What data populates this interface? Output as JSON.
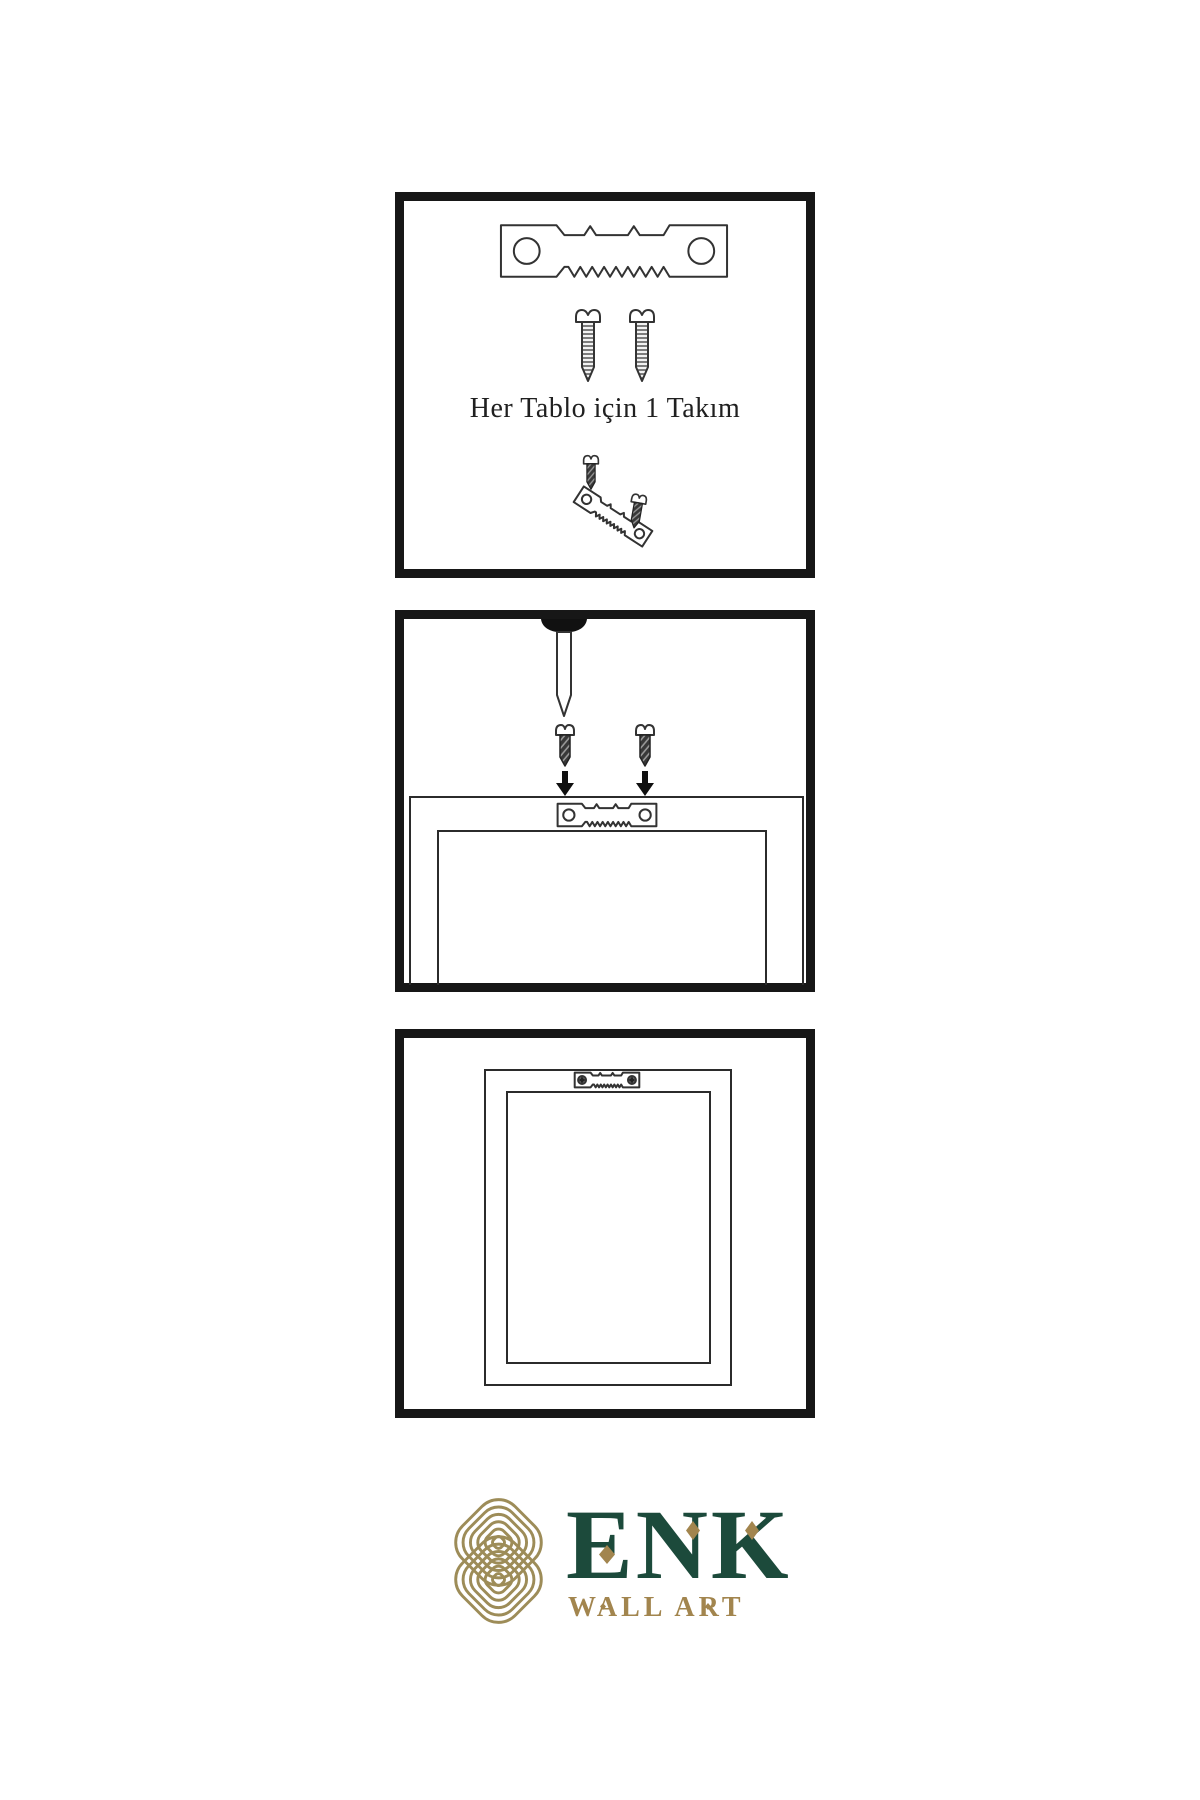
{
  "page": {
    "background": "#ffffff",
    "type": "product-instruction-sheet"
  },
  "steps": [
    {
      "id": "hardware-kit",
      "caption": "Her Tablo için 1 Takım",
      "items": [
        "sawtooth-hanger",
        "screw",
        "screw",
        "small-screw",
        "tilted-sawtooth-hanger-with-screws"
      ]
    },
    {
      "id": "attach-hanger-to-frame",
      "items": [
        "wall-nail",
        "screw",
        "screw",
        "down-arrow",
        "down-arrow",
        "frame-back",
        "sawtooth-hanger"
      ]
    },
    {
      "id": "hanger-mounted",
      "items": [
        "frame-back",
        "mounted-sawtooth-hanger-with-screw-heads"
      ]
    }
  ],
  "logo": {
    "brand": "ENK",
    "tagline": "WALL ART",
    "colors": {
      "brand_green": "#1c4a3b",
      "brand_gold": "#a2854e",
      "knot_gold": "#9d8c58"
    }
  }
}
